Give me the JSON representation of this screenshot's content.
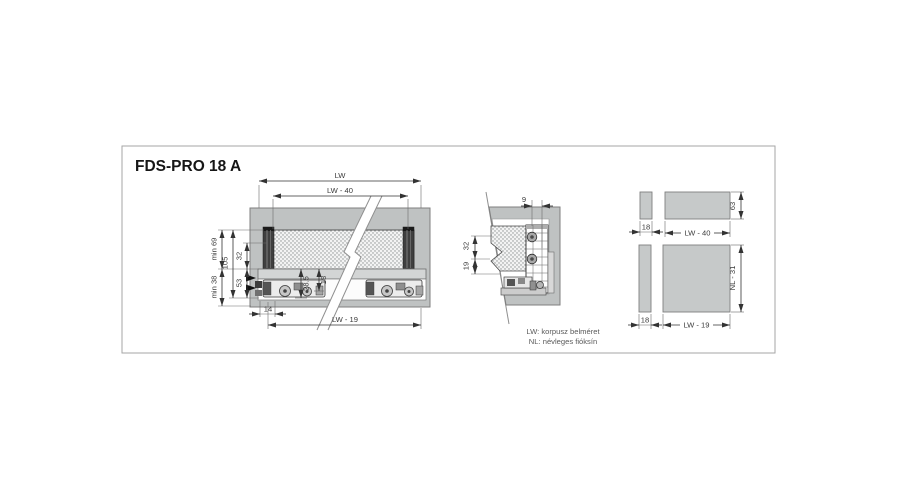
{
  "title": "FDS-PRO 18 A",
  "legend": {
    "line1": "LW: korpusz belméret",
    "line2": "NL: névleges fióksín"
  },
  "side_view": {
    "dim_lw": "LW",
    "dim_lw_minus_40": "LW - 40",
    "dim_lw_minus_19": "LW - 19",
    "dim_min_69": "min 69",
    "dim_105": "105",
    "dim_32": "32",
    "dim_min_38": "min 38",
    "dim_53": "53",
    "dim_28_5": "28.5",
    "dim_18": "18",
    "dim_14": "14"
  },
  "cross_section": {
    "dim_9": "9",
    "dim_32": "32",
    "dim_19": "19"
  },
  "cutting_pattern_top": {
    "dim_18": "18",
    "dim_lw_minus_40": "LW - 40",
    "dim_63": "63"
  },
  "cutting_pattern_bottom": {
    "dim_18": "18",
    "dim_lw_minus_19": "LW - 19",
    "dim_nl_minus_31": "NL - 31"
  },
  "colors": {
    "cabinet_gray": "#bfc2c2",
    "panel_dot_fill": "#f3f3f3",
    "dimension_line": "#333333",
    "frame_border": "#a6a6a6"
  }
}
